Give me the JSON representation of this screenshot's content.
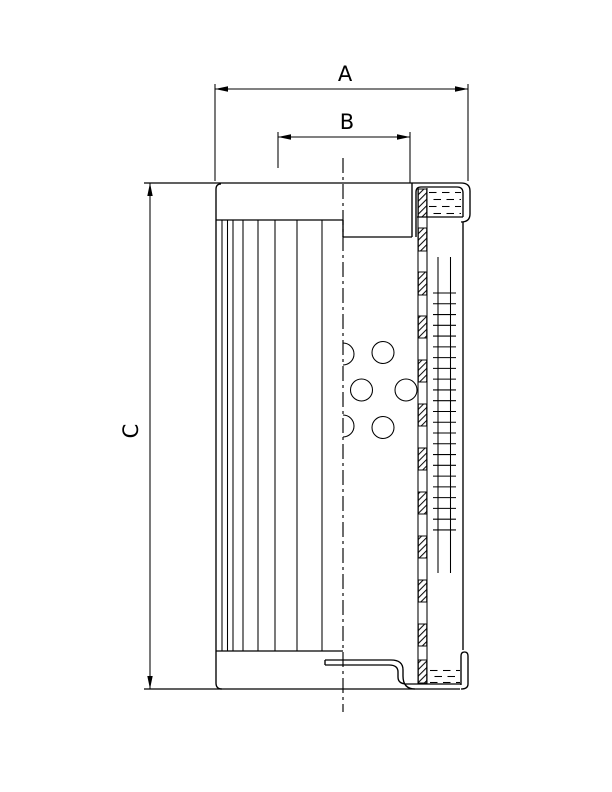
{
  "colors": {
    "background": "#ffffff",
    "ink": "#000000"
  },
  "dimensions": {
    "a_label": "A",
    "b_label": "B",
    "c_label": "C"
  }
}
